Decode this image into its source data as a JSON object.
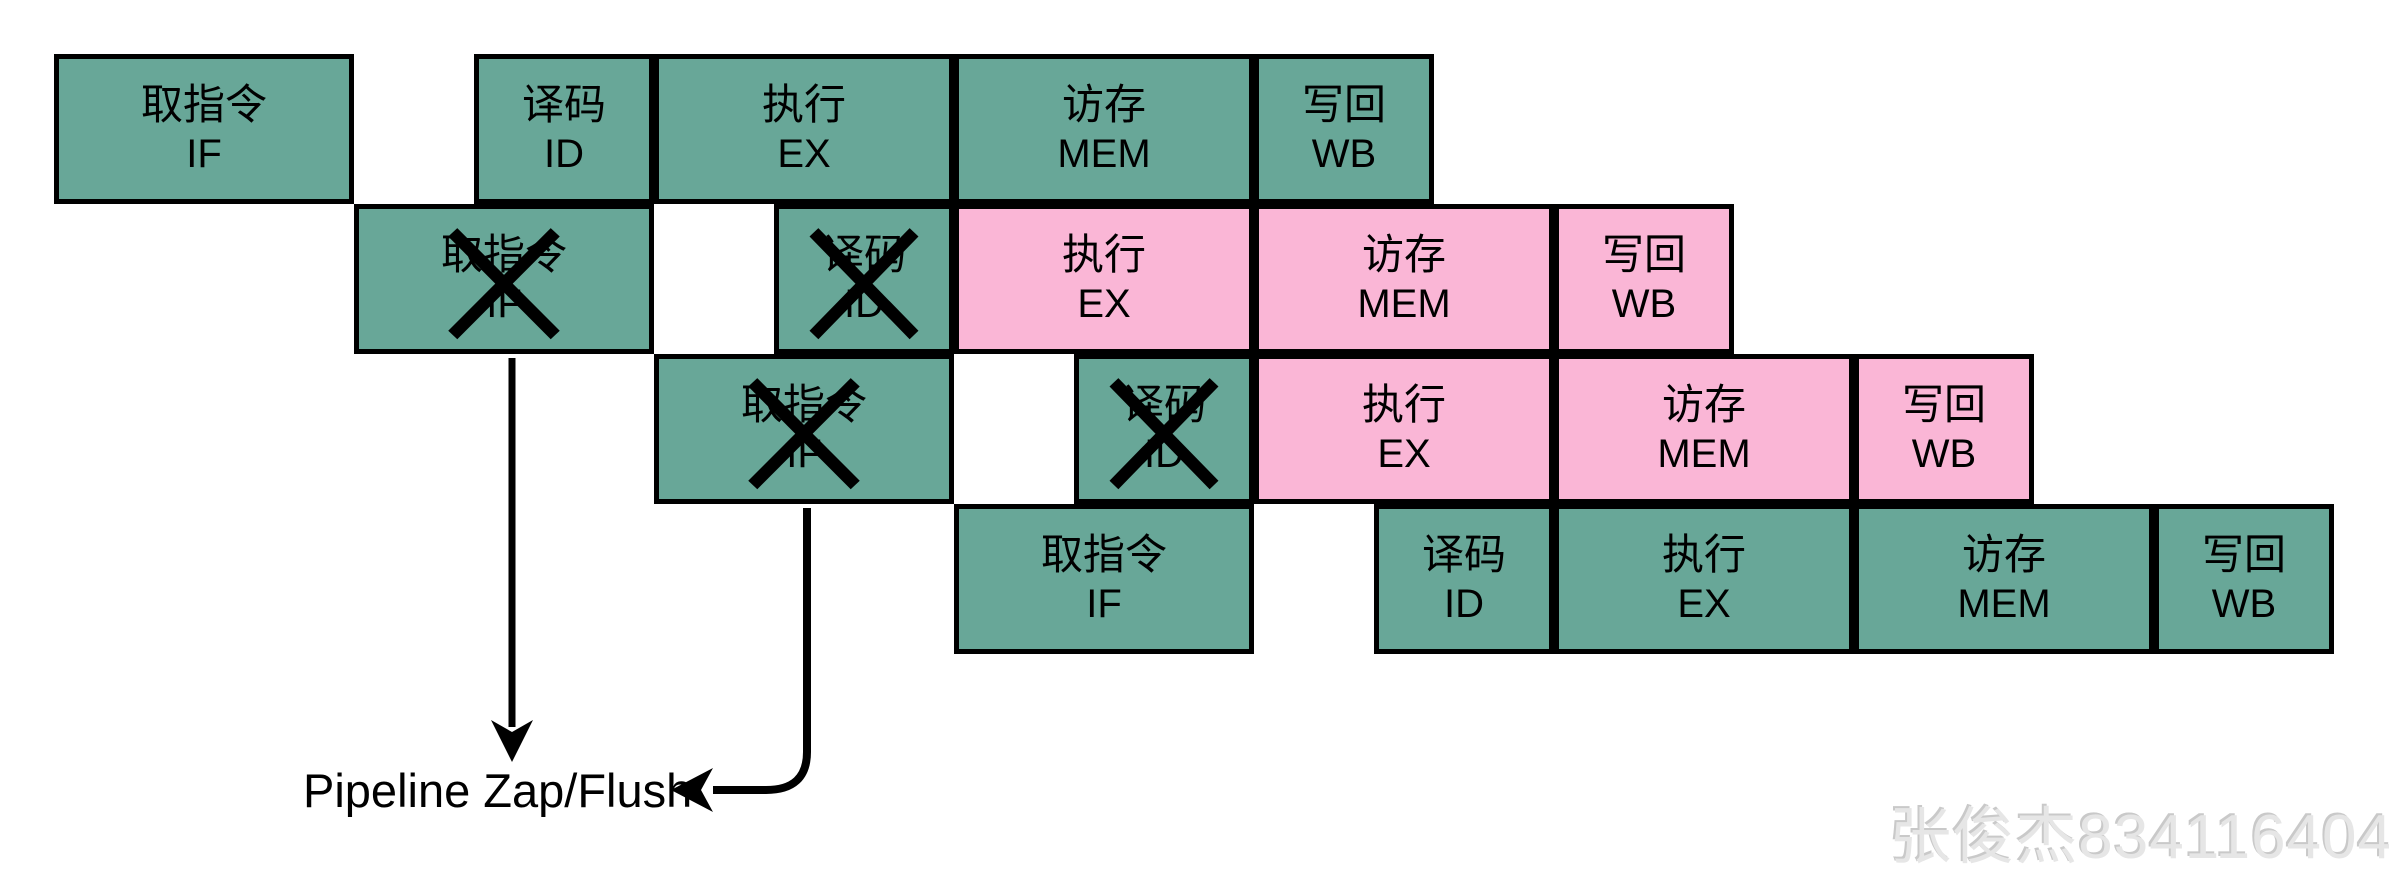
{
  "colors": {
    "teal": "#68A798",
    "pink": "#FAB6D6",
    "border": "#000000",
    "text": "#000000",
    "watermark_gray": "#e6e6e6"
  },
  "stages": {
    "IF": {
      "zh": "取指令",
      "en": "IF"
    },
    "ID": {
      "zh": "译码",
      "en": "ID"
    },
    "EX": {
      "zh": "执行",
      "en": "EX"
    },
    "MEM": {
      "zh": "访存",
      "en": "MEM"
    },
    "WB": {
      "zh": "写回",
      "en": "WB"
    }
  },
  "rows": [
    {
      "name": "instruction-1",
      "boxes": [
        {
          "stage": "IF",
          "zh": "取指令",
          "en": "IF",
          "fill": "teal",
          "crossed": false,
          "x": 54,
          "w": 300
        },
        {
          "stage": "ID",
          "zh": "译码",
          "en": "ID",
          "fill": "teal",
          "crossed": false,
          "x": 474,
          "w": 180
        },
        {
          "stage": "EX",
          "zh": "执行",
          "en": "EX",
          "fill": "teal",
          "crossed": false,
          "x": 654,
          "w": 300
        },
        {
          "stage": "MEM",
          "zh": "访存",
          "en": "MEM",
          "fill": "teal",
          "crossed": false,
          "x": 954,
          "w": 300
        },
        {
          "stage": "WB",
          "zh": "写回",
          "en": "WB",
          "fill": "teal",
          "crossed": false,
          "x": 1254,
          "w": 180
        }
      ]
    },
    {
      "name": "instruction-2",
      "boxes": [
        {
          "stage": "IF",
          "zh": "取指令",
          "en": "IF",
          "fill": "teal",
          "crossed": true,
          "x": 354,
          "w": 300
        },
        {
          "stage": "ID",
          "zh": "译码",
          "en": "ID",
          "fill": "teal",
          "crossed": true,
          "x": 774,
          "w": 180
        },
        {
          "stage": "EX",
          "zh": "执行",
          "en": "EX",
          "fill": "pink",
          "crossed": false,
          "x": 954,
          "w": 300
        },
        {
          "stage": "MEM",
          "zh": "访存",
          "en": "MEM",
          "fill": "pink",
          "crossed": false,
          "x": 1254,
          "w": 300
        },
        {
          "stage": "WB",
          "zh": "写回",
          "en": "WB",
          "fill": "pink",
          "crossed": false,
          "x": 1554,
          "w": 180
        }
      ]
    },
    {
      "name": "instruction-3",
      "boxes": [
        {
          "stage": "IF",
          "zh": "取指令",
          "en": "IF",
          "fill": "teal",
          "crossed": true,
          "x": 654,
          "w": 300
        },
        {
          "stage": "ID",
          "zh": "译码",
          "en": "ID",
          "fill": "teal",
          "crossed": true,
          "x": 1074,
          "w": 180
        },
        {
          "stage": "EX",
          "zh": "执行",
          "en": "EX",
          "fill": "pink",
          "crossed": false,
          "x": 1254,
          "w": 300
        },
        {
          "stage": "MEM",
          "zh": "访存",
          "en": "MEM",
          "fill": "pink",
          "crossed": false,
          "x": 1554,
          "w": 300
        },
        {
          "stage": "WB",
          "zh": "写回",
          "en": "WB",
          "fill": "pink",
          "crossed": false,
          "x": 1854,
          "w": 180
        }
      ]
    },
    {
      "name": "instruction-4",
      "boxes": [
        {
          "stage": "IF",
          "zh": "取指令",
          "en": "IF",
          "fill": "teal",
          "crossed": false,
          "x": 954,
          "w": 300
        },
        {
          "stage": "ID",
          "zh": "译码",
          "en": "ID",
          "fill": "teal",
          "crossed": false,
          "x": 1374,
          "w": 180
        },
        {
          "stage": "EX",
          "zh": "执行",
          "en": "EX",
          "fill": "teal",
          "crossed": false,
          "x": 1554,
          "w": 300
        },
        {
          "stage": "MEM",
          "zh": "访存",
          "en": "MEM",
          "fill": "teal",
          "crossed": false,
          "x": 1854,
          "w": 300
        },
        {
          "stage": "WB",
          "zh": "写回",
          "en": "WB",
          "fill": "teal",
          "crossed": false,
          "x": 2154,
          "w": 180
        }
      ]
    }
  ],
  "layout_rows_y": [
    54,
    204,
    354,
    504
  ],
  "row_height": 150,
  "annotation": {
    "label": "Pipeline Zap/Flush"
  },
  "watermark": {
    "text": "张俊杰834116404"
  }
}
